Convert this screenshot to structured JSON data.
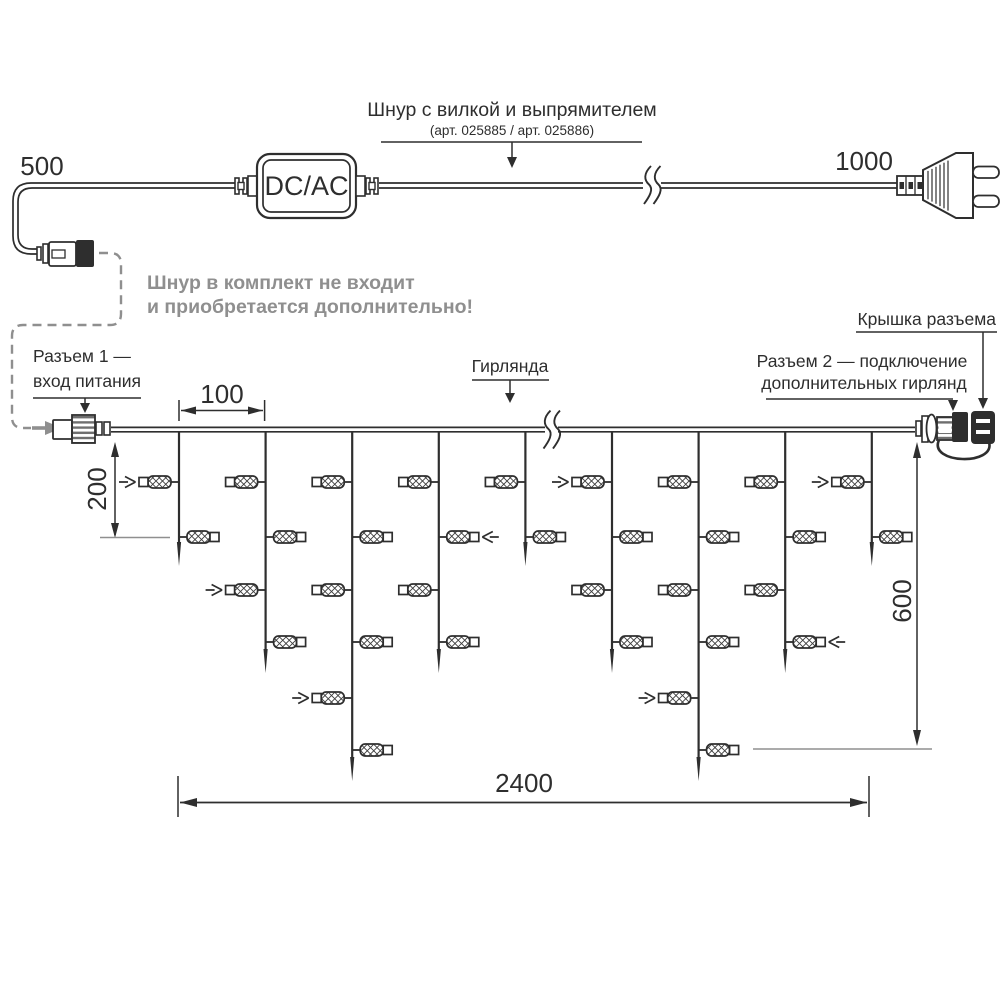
{
  "colors": {
    "ink": "#2e2e2e",
    "gray": "#8f8f8f",
    "hatch": "#3d3d3d",
    "rib": "#6e6e6e"
  },
  "power_cord": {
    "length_left_label": "500",
    "length_right_label": "1000",
    "converter_label": "DC/AC",
    "title": "Шнур с вилкой и выпрямителем",
    "subtitle": "(арт. 025885 /  арт. 025886)",
    "note_line1": "Шнур в комплект не входит",
    "note_line2": "и приобретается дополнительно!"
  },
  "garland": {
    "connector1_label_line1": "Разъем 1 —",
    "connector1_label_line2": "вход питания",
    "garland_label": "Гирлянда",
    "connector2_label_line1": "Разъем 2 — подключение",
    "connector2_label_line2": "дополнительных гирлянд",
    "cap_label": "Крышка разъема",
    "dims": {
      "drop_spacing": "100",
      "short_drop": "200",
      "height": "600",
      "total_length": "2400"
    },
    "structure": {
      "drop_pattern": [
        "short",
        "medium",
        "long",
        "medium",
        "short",
        "medium",
        "long",
        "medium",
        "short"
      ],
      "lamp_rows_by_type": {
        "short": 2,
        "medium": 4,
        "long": 6
      },
      "arrow_markers": [
        {
          "drop": 0,
          "row": 0
        },
        {
          "drop": 1,
          "row": 2
        },
        {
          "drop": 2,
          "row": 4
        },
        {
          "drop": 3,
          "row": 1
        },
        {
          "drop": 5,
          "row": 0
        },
        {
          "drop": 6,
          "row": 4
        },
        {
          "drop": 7,
          "row": 3
        },
        {
          "drop": 8,
          "row": 0
        }
      ]
    }
  }
}
